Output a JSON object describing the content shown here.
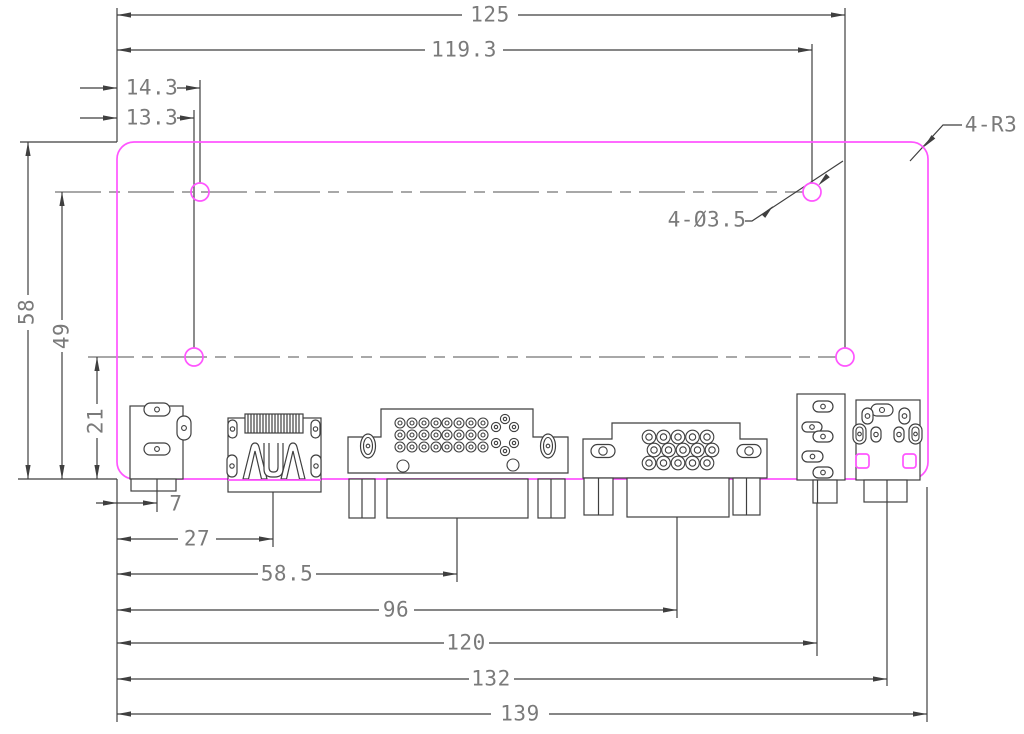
{
  "drawing": {
    "kind": "pcb-outline-dimension-drawing",
    "colors": {
      "board_outline": "#ff55ff",
      "dimension_line": "#3f3f3f",
      "dimension_text": "#7a7a7a",
      "centerline": "#8c8c8c",
      "background": "#ffffff"
    },
    "board": {
      "outline_shape": "rounded-rectangle",
      "mounting_hole_count": 4,
      "corner_note": "4-R3",
      "hole_note": "4-Ø3.5"
    },
    "dimensions": {
      "top": [
        "125",
        "119.3",
        "14.3",
        "13.3"
      ],
      "left": [
        "58",
        "49",
        "21"
      ],
      "bottom": [
        "7",
        "27",
        "58.5",
        "96",
        "120",
        "132",
        "139"
      ]
    },
    "labels": {
      "dim_125": "125",
      "dim_119_3": "119.3",
      "dim_14_3": "14.3",
      "dim_13_3": "13.3",
      "dim_58": "58",
      "dim_49": "49",
      "dim_21": "21",
      "dim_7": "7",
      "dim_27": "27",
      "dim_58_5": "58.5",
      "dim_96": "96",
      "dim_120": "120",
      "dim_132": "132",
      "dim_139": "139",
      "hole_note": "4-Ø3.5",
      "corner_note": "4-R3"
    },
    "connectors": [
      "dc-power-jack",
      "hdmi-port",
      "dvi-port",
      "vga-port",
      "audio-jack-block",
      "av-jack-block"
    ]
  }
}
